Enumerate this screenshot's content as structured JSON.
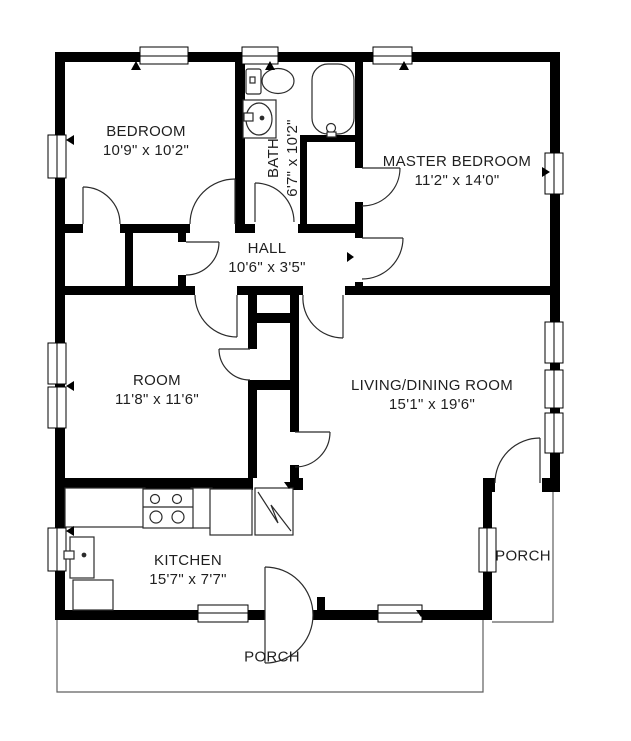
{
  "title": "Floor plan",
  "rooms": {
    "bedroom": {
      "name": "BEDROOM",
      "dims": "10'9\" x 10'2\""
    },
    "bath": {
      "name": "BATH",
      "dims": "6'7\" x 10'2\""
    },
    "master_bedroom": {
      "name": "MASTER BEDROOM",
      "dims": "11'2\" x 14'0\""
    },
    "hall": {
      "name": "HALL",
      "dims": "10'6\" x 3'5\""
    },
    "room": {
      "name": "ROOM",
      "dims": "11'8\" x 11'6\""
    },
    "living_dining": {
      "name": "LIVING/DINING ROOM",
      "dims": "15'1\" x 19'6\""
    },
    "kitchen": {
      "name": "KITCHEN",
      "dims": "15'7\" x 7'7\""
    },
    "porch_right": {
      "name": "PORCH"
    },
    "porch_bottom": {
      "name": "PORCH"
    }
  },
  "colors": {
    "wall": "#000000",
    "background": "#ffffff",
    "text": "#1f1f1f",
    "fixture_stroke": "#2b2b2b",
    "porch_outline": "#5f5f5f"
  }
}
